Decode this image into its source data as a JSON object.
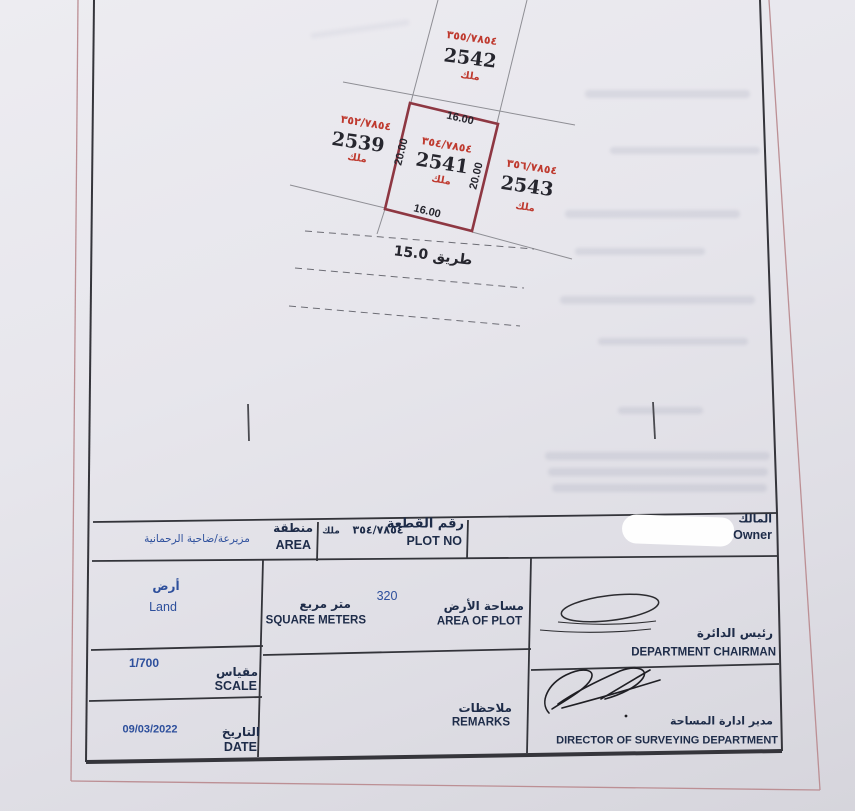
{
  "map": {
    "plots": [
      {
        "parcel_no": "٣٥٥/٧٨٥٤",
        "plot_no": "2542",
        "tenure": "ملك"
      },
      {
        "parcel_no": "٣٥٢/٧٨٥٤",
        "plot_no": "2539",
        "tenure": "ملك"
      },
      {
        "parcel_no": "٣٥٤/٧٨٥٤",
        "plot_no": "2541",
        "tenure": "ملك"
      },
      {
        "parcel_no": "٣٥٦/٧٨٥٤",
        "plot_no": "2543",
        "tenure": "ملك"
      }
    ],
    "dims": {
      "top": "16.00",
      "bottom": "16.00",
      "left": "20.00",
      "right": "20.00"
    },
    "road": "طريق 15.0"
  },
  "table": {
    "area": {
      "label_ar": "منطقة",
      "label_en": "AREA",
      "value": "مزيرعة/ضاحية الرحمانية"
    },
    "plot_no": {
      "label_ar": "رقم القطعة",
      "label_en": "PLOT NO",
      "tenure": "ملك",
      "value": "٣٥٤/٧٨٥٤"
    },
    "owner": {
      "label_ar": "المالك",
      "label_en": "Owner"
    },
    "type": {
      "value_ar": "أرض",
      "value_en": "Land"
    },
    "area_of_plot": {
      "unit_ar": "متر مربع",
      "unit_en": "SQUARE METERS",
      "label_ar": "مساحة الأرض",
      "label_en": "AREA OF PLOT",
      "value": "320"
    },
    "chairman": {
      "label_ar": "رئيس الدائرة",
      "label_en": "DEPARTMENT CHAIRMAN"
    },
    "scale": {
      "label_ar": "مقياس",
      "label_en": "SCALE",
      "value": "1/700"
    },
    "remarks": {
      "label_ar": "ملاحظات",
      "label_en": "REMARKS"
    },
    "director": {
      "label_ar": "مدير ادارة المساحة",
      "label_en": "DIRECTOR OF SURVEYING DEPARTMENT"
    },
    "date": {
      "label_ar": "التاريخ",
      "label_en": "DATE",
      "value": "09/03/2022"
    }
  },
  "colors": {
    "plot_outline_red": "#8e3742",
    "map_red_text": "#bf3a2f",
    "value_blue": "#2d4f9c",
    "label_navy": "#1e2c49",
    "page_border_red": "#bc8f94",
    "table_border": "#33343a"
  }
}
